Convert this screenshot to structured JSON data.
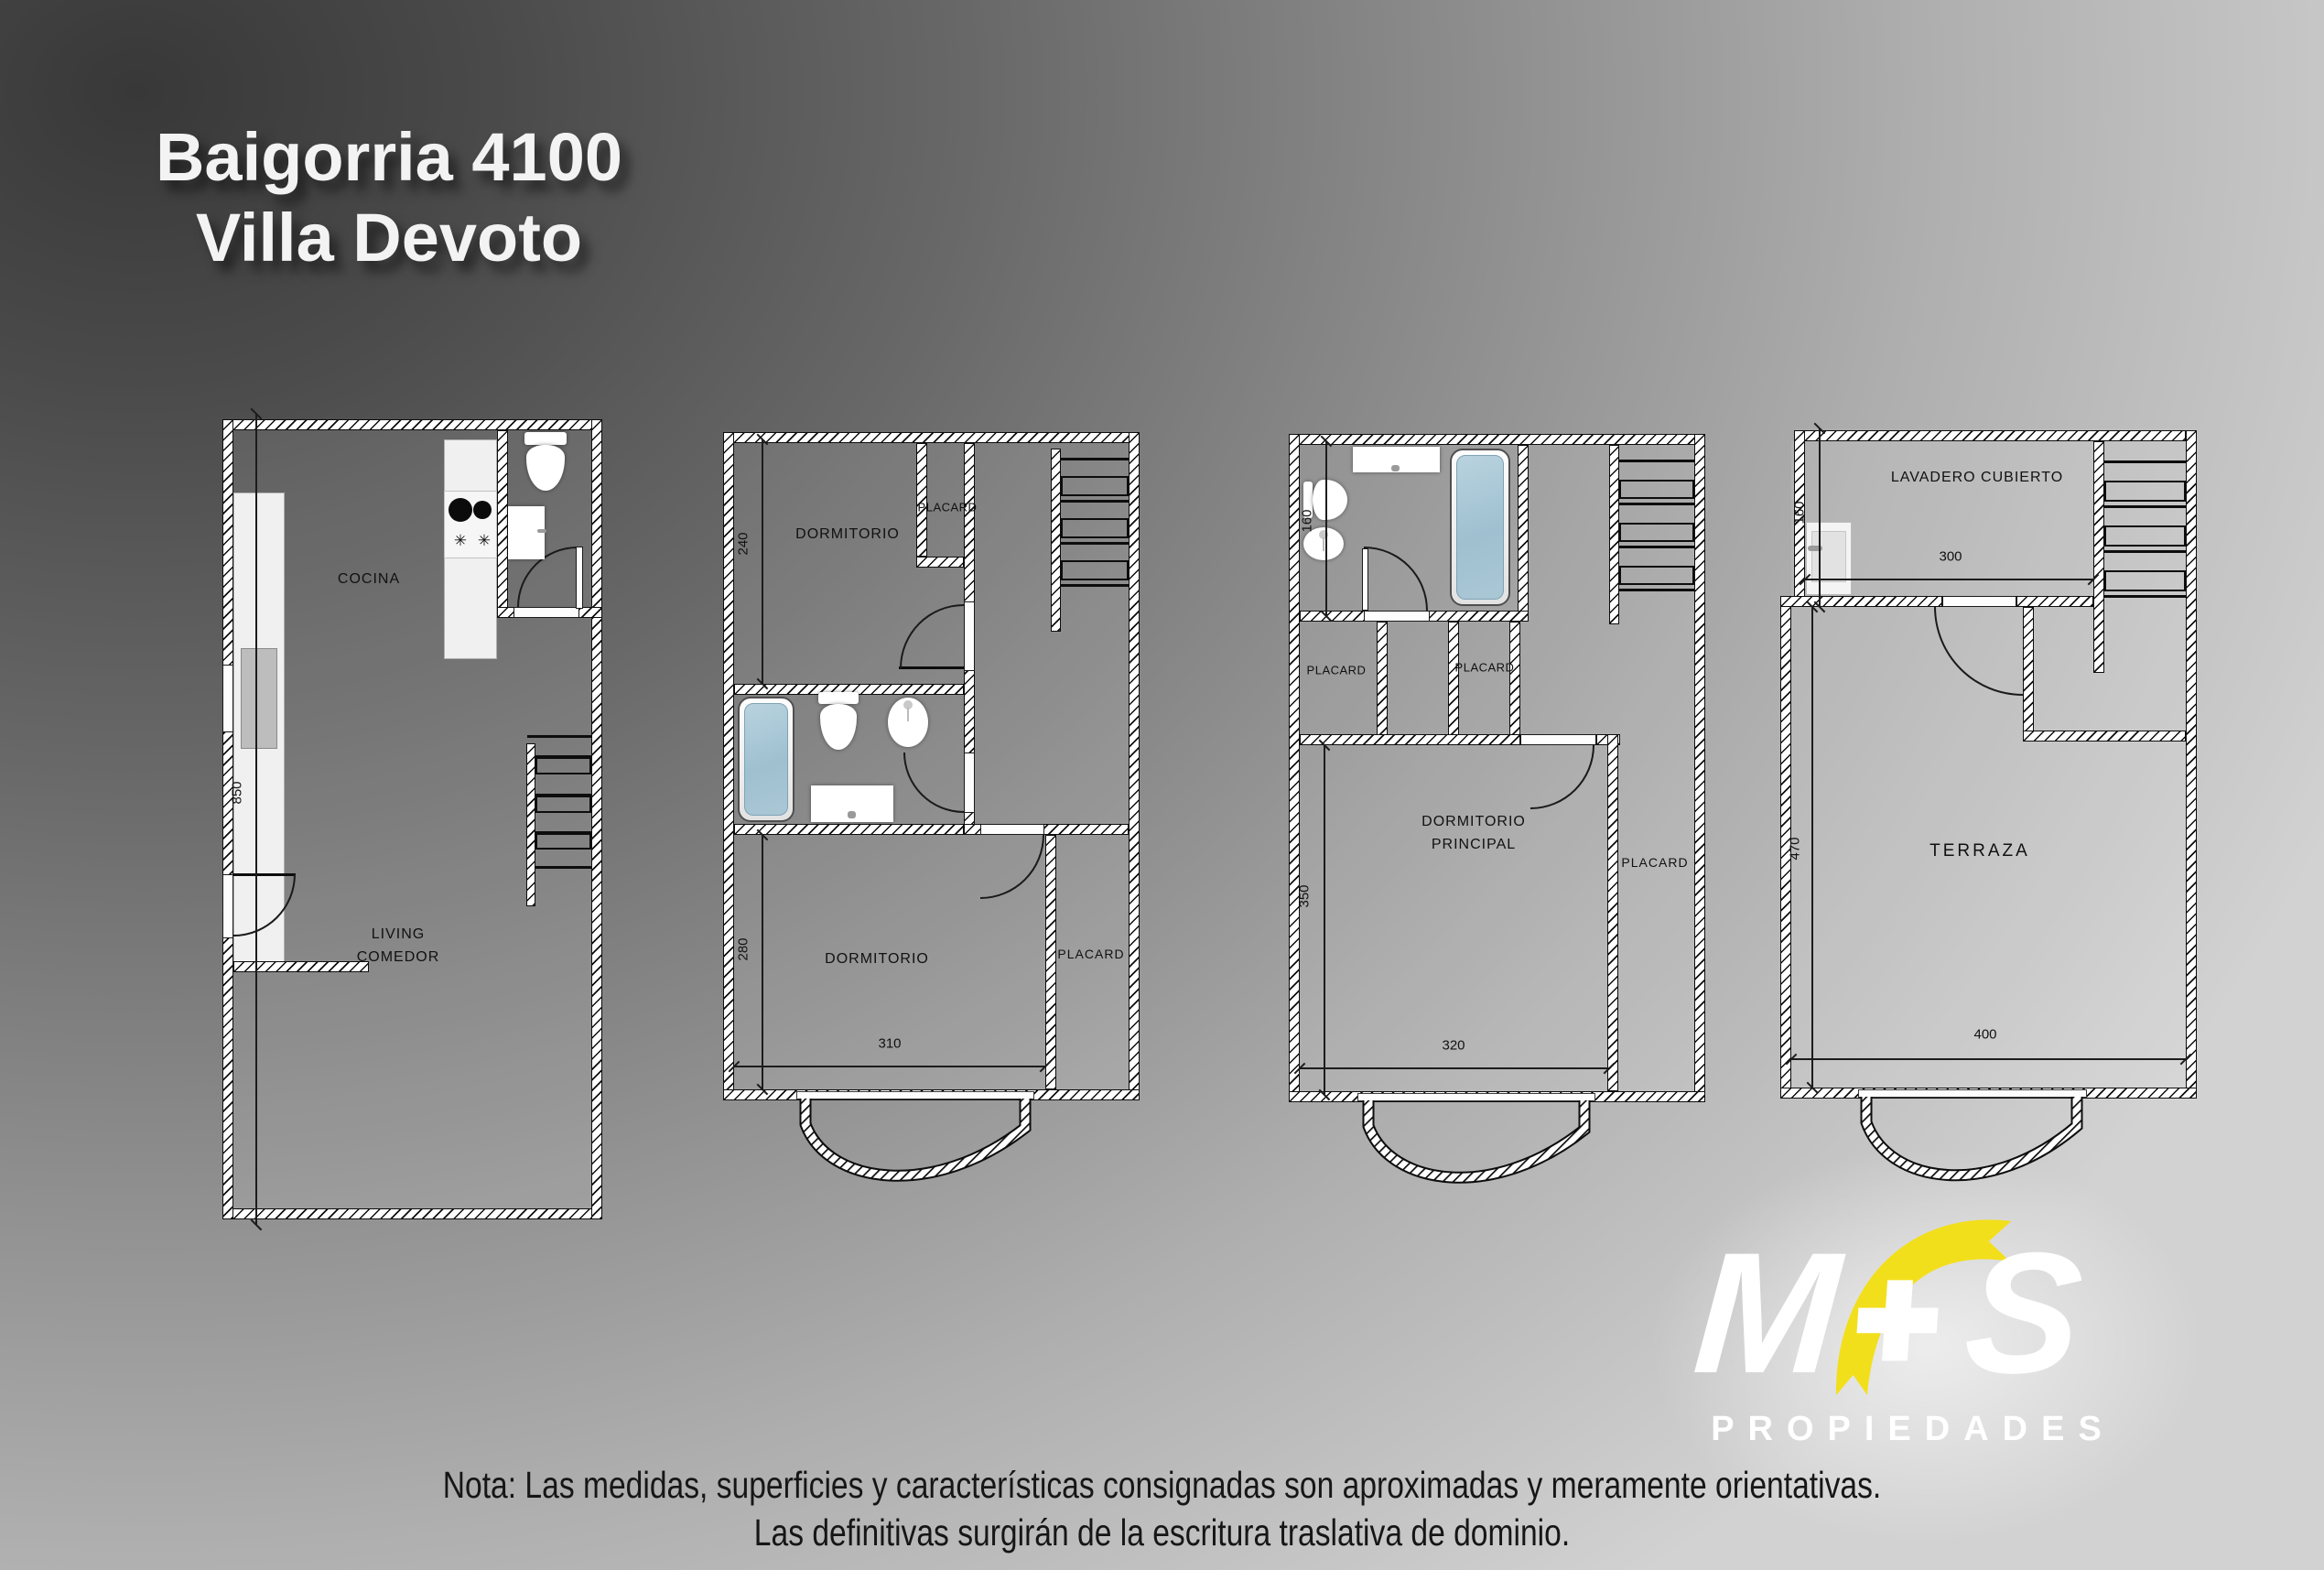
{
  "title": {
    "line1": "Baigorria 4100",
    "line2": "Villa Devoto"
  },
  "plans": {
    "plan1": {
      "cocina": "COCINA",
      "living1": "LIVING",
      "living2": "COMEDOR",
      "dim_850": "850"
    },
    "plan2": {
      "dorm_top": "DORMITORIO",
      "placard_top": "PLACARD",
      "dorm_bottom": "DORMITORIO",
      "placard_bottom": "PLACARD",
      "dim_240": "240",
      "dim_280": "280",
      "dim_310": "310"
    },
    "plan3": {
      "placard_left": "PLACARD",
      "placard_mid": "PLACARD",
      "placard_right": "PLACARD",
      "dorm1": "DORMITORIO",
      "dorm2": "PRINCIPAL",
      "dim_160": "160",
      "dim_350": "350",
      "dim_320": "320"
    },
    "plan4": {
      "lavadero": "LAVADERO CUBIERTO",
      "terraza": "TERRAZA",
      "dim_160": "160",
      "dim_300": "300",
      "dim_470": "470",
      "dim_400": "400"
    }
  },
  "fixtures": {
    "burner_symbol": "✳"
  },
  "logo": {
    "m": "M",
    "plus": "+",
    "s": "S",
    "subtitle": "PROPIEDADES"
  },
  "note": {
    "line1": "Nota: Las medidas, superficies y características consignadas son aproximadas y meramente orientativas.",
    "line2": "Las definitivas surgirán de la escritura traslativa de dominio."
  },
  "colors": {
    "logo_yellow": "#f2df1b",
    "tub_fill": "#a9c7d6",
    "background_dark": "#3a3a3a",
    "background_light": "#d2d2d2"
  }
}
